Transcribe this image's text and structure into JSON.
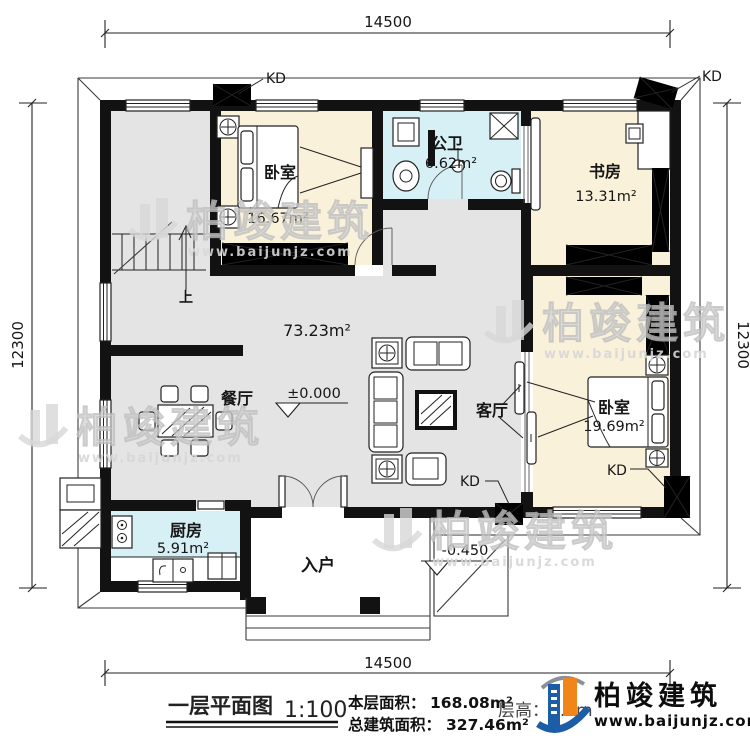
{
  "drawing": {
    "dimensions": {
      "top": "14500",
      "bottom": "14500",
      "left": "12300",
      "right": "12300"
    },
    "rooms": {
      "bedroom1": {
        "name": "卧室",
        "area": "16.67m²"
      },
      "bathroom": {
        "name": "公卫",
        "area": "6.62m²"
      },
      "study": {
        "name": "书房",
        "area": "13.31m²"
      },
      "hall": {
        "area": "73.23m²"
      },
      "dining": {
        "name": "餐厅"
      },
      "living": {
        "name": "客厅"
      },
      "bedroom2": {
        "name": "卧室",
        "area": "19.69m²"
      },
      "kitchen": {
        "name": "厨房",
        "area": "5.91m²"
      },
      "entry": {
        "name": "入户"
      }
    },
    "levels": {
      "ground": "±0.000",
      "entry": "-0.450"
    },
    "marks": {
      "kd": "KD",
      "up": "上"
    }
  },
  "title_block": {
    "plan_name": "一层平面图",
    "scale": "1:100",
    "floor_area_label": "本层面积：",
    "floor_area_value": "168.08m²",
    "total_area_label": "总建筑面积：",
    "total_area_value": "327.46m²",
    "floor_height": "层高：3.6m",
    "brand": {
      "name": "柏竣建筑",
      "site": "www.baijunjz.com"
    }
  },
  "watermark": {
    "text": "柏竣建筑",
    "site": "www.baijunjz.com"
  },
  "colors": {
    "wall": "#121212",
    "floor_hall": "#e4e4e4",
    "floor_room": "#faf1da",
    "floor_wet": "#d6f0f5",
    "brand_blue": "#1d5da5",
    "brand_orange": "#f08519"
  }
}
